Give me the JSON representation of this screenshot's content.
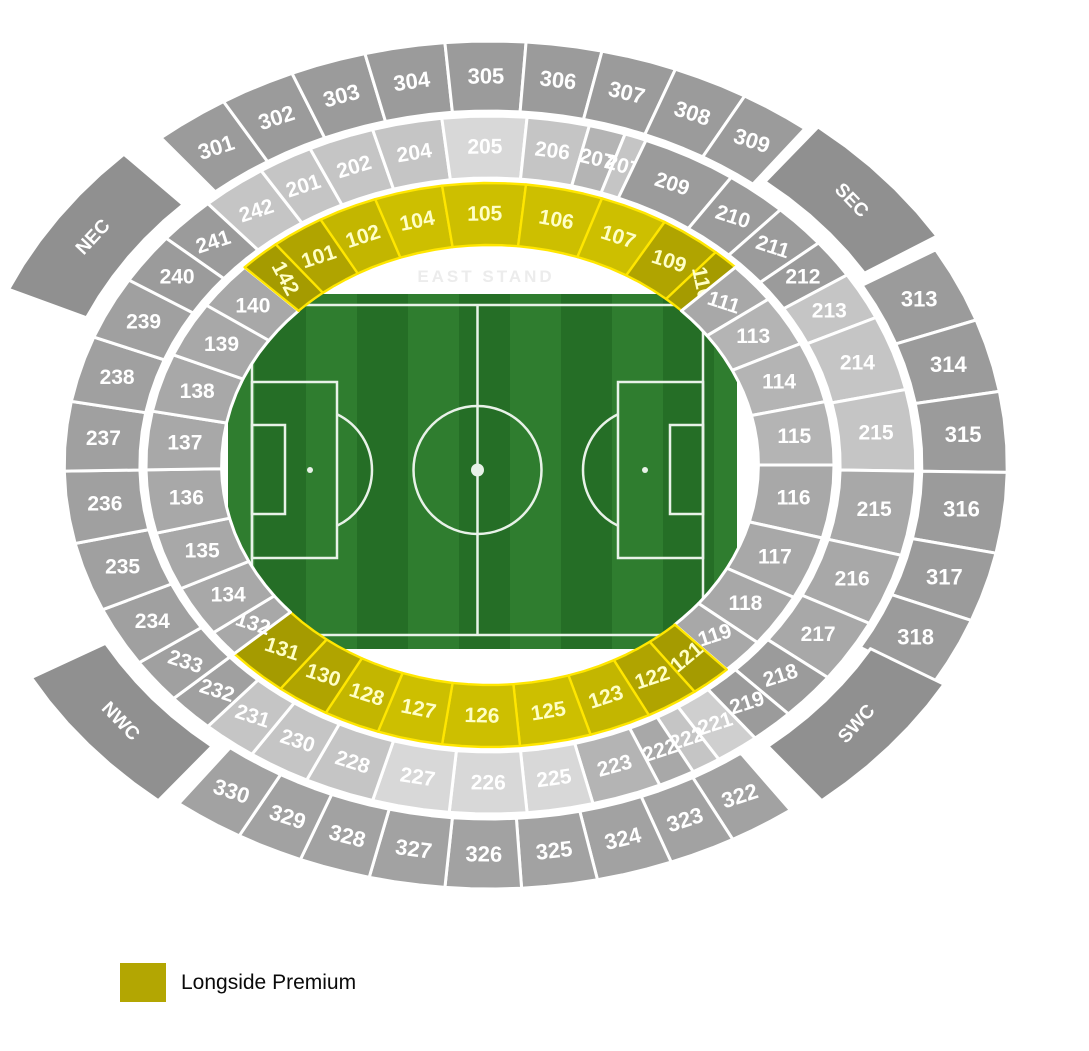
{
  "legend": {
    "label": "Longside Premium",
    "color": "#b3a602"
  },
  "stand_label": "EAST STAND",
  "palette": {
    "YB": "#cdbf00",
    "YB2": "#c3b600",
    "YM": "#b0a400",
    "YD": "#a59b00",
    "G1": "#9b9b9b",
    "G1b": "#a0a0a0",
    "G1c": "#a2a2a2",
    "G2": "#a8a8a8",
    "G3": "#b4b4b4",
    "G4": "#c5c5c5",
    "G5": "#d8d8d8",
    "G6": "#cfcfcf",
    "B": "#909090",
    "yellow_text": "#ffffc6",
    "white_text": "#ffffff",
    "stroke_yellow": "#ffe600",
    "stroke_white": "#ffffff"
  },
  "stadium": {
    "cx": 490,
    "cy": 465,
    "kx": 1.22,
    "ky": 1.0,
    "rings": {
      "r1": [
        220,
        282
      ],
      "r2": [
        287,
        349
      ],
      "r3": [
        354,
        424
      ],
      "b": [
        362,
        432
      ]
    },
    "font_by_ring": {
      "r1": 21,
      "r2": 21,
      "r3": 22,
      "b": 19
    },
    "sections": [
      [
        "140",
        "r1",
        135.5,
        146,
        "G2",
        null
      ],
      [
        "142",
        "r1",
        128.5,
        135.5,
        "YD",
        62
      ],
      [
        "101",
        "r1",
        119.5,
        128.5,
        "YM",
        null
      ],
      [
        "102",
        "r1",
        109.5,
        119.5,
        "YB2",
        null
      ],
      [
        "104",
        "r1",
        98,
        109.5,
        "YB",
        null
      ],
      [
        "105",
        "r1",
        84,
        98,
        "YB",
        null
      ],
      [
        "106",
        "r1",
        71,
        84,
        "YB",
        null
      ],
      [
        "107",
        "r1",
        59.5,
        71,
        "YB",
        null
      ],
      [
        "109",
        "r1",
        49,
        59.5,
        "YM",
        null
      ],
      [
        "110",
        "r1",
        43.5,
        49,
        "YD",
        78
      ],
      [
        "111",
        "r1",
        36,
        44.5,
        "G2",
        null
      ],
      [
        "113",
        "r1",
        25.5,
        36,
        "G3",
        null
      ],
      [
        "114",
        "r1",
        13,
        25.5,
        "G3",
        null
      ],
      [
        "115",
        "r1",
        0,
        13,
        "G3",
        null
      ],
      [
        "116",
        "r1",
        345,
        360,
        "G2",
        null
      ],
      [
        "117",
        "r1",
        332,
        345,
        "G2",
        null
      ],
      [
        "118",
        "r1",
        321,
        332,
        "G2",
        null
      ],
      [
        "119",
        "r1",
        313.5,
        321,
        "G2",
        null
      ],
      [
        "121",
        "r1",
        306.5,
        313.5,
        "YD",
        -40
      ],
      [
        "122",
        "r1",
        297.5,
        306.5,
        "YM",
        null
      ],
      [
        "123",
        "r1",
        287,
        297.5,
        "YB2",
        null
      ],
      [
        "125",
        "r1",
        275,
        287,
        "YB",
        null
      ],
      [
        "126",
        "r1",
        262,
        275,
        "YB",
        null
      ],
      [
        "127",
        "r1",
        251,
        262,
        "YB",
        null
      ],
      [
        "128",
        "r1",
        241.5,
        251,
        "YB2",
        null
      ],
      [
        "130",
        "r1",
        232.5,
        241.5,
        "YM",
        null
      ],
      [
        "131",
        "r1",
        222,
        232.5,
        "YD",
        null
      ],
      [
        "132",
        "r1",
        216.5,
        222,
        "G2",
        null
      ],
      [
        "134",
        "r1",
        206,
        216.5,
        "G2",
        null
      ],
      [
        "135",
        "r1",
        194,
        206,
        "G2",
        null
      ],
      [
        "136",
        "r1",
        181,
        194,
        "G2",
        null
      ],
      [
        "137",
        "r1",
        169,
        181,
        "G2",
        null
      ],
      [
        "138",
        "r1",
        157,
        169,
        "G2",
        null
      ],
      [
        "139",
        "r1",
        145.5,
        157,
        "G2",
        null
      ],
      [
        "241",
        "r2",
        131.5,
        139.5,
        "G1",
        null
      ],
      [
        "242",
        "r2",
        122.5,
        131.5,
        "G4",
        null
      ],
      [
        "201",
        "r2",
        115,
        122.5,
        "G4",
        null
      ],
      [
        "202",
        "r2",
        106,
        115,
        "G4",
        null
      ],
      [
        "204",
        "r2",
        96.5,
        106,
        "G4",
        null
      ],
      [
        "205",
        "r2",
        85,
        96.5,
        "G5",
        null
      ],
      [
        "206",
        "r2",
        76.5,
        85,
        "G4",
        null
      ],
      [
        "207",
        "r2",
        71.5,
        76.5,
        "G3",
        null
      ],
      [
        "207",
        "r2",
        68.5,
        71.5,
        "G4",
        null
      ],
      [
        "209",
        "r2",
        55.5,
        68.5,
        "G1",
        null
      ],
      [
        "210",
        "r2",
        47,
        55.5,
        "G1",
        null
      ],
      [
        "211",
        "r2",
        39.5,
        47,
        "G1",
        null
      ],
      [
        "212",
        "r2",
        33,
        39.5,
        "G1",
        null
      ],
      [
        "213",
        "r2",
        25,
        33,
        "G4",
        null
      ],
      [
        "214",
        "r2",
        12.5,
        25,
        "G4",
        null
      ],
      [
        "215",
        "r2",
        -1,
        12.5,
        "G4",
        null
      ],
      [
        "215",
        "r2",
        345,
        359,
        "G2",
        null
      ],
      [
        "216",
        "r2",
        333,
        345,
        "G2",
        null
      ],
      [
        "217",
        "r2",
        322.5,
        333,
        "G2",
        null
      ],
      [
        "218",
        "r2",
        314.5,
        322.5,
        "G1",
        null
      ],
      [
        "219",
        "r2",
        308.5,
        314.5,
        "G1",
        null
      ],
      [
        "221",
        "r2",
        302.5,
        308.5,
        "G6",
        null
      ],
      [
        "222",
        "r2",
        298.5,
        302.5,
        "G4",
        null
      ],
      [
        "222",
        "r2",
        293.5,
        298.5,
        "G2",
        null
      ],
      [
        "223",
        "r2",
        284,
        293.5,
        "G3",
        null
      ],
      [
        "225",
        "r2",
        275,
        284,
        "G5",
        null
      ],
      [
        "226",
        "r2",
        264.5,
        275,
        "G5",
        null
      ],
      [
        "227",
        "r2",
        254,
        264.5,
        "G5",
        null
      ],
      [
        "228",
        "r2",
        244.5,
        254,
        "G4",
        null
      ],
      [
        "230",
        "r2",
        236,
        244.5,
        "G4",
        null
      ],
      [
        "231",
        "r2",
        228.5,
        236,
        "G4",
        null
      ],
      [
        "232",
        "r2",
        222,
        228.5,
        "G1b",
        null
      ],
      [
        "233",
        "r2",
        214.5,
        222,
        "G1b",
        null
      ],
      [
        "234",
        "r2",
        204.5,
        214.5,
        "G1b",
        null
      ],
      [
        "235",
        "r2",
        193,
        204.5,
        "G1b",
        null
      ],
      [
        "236",
        "r2",
        181,
        193,
        "G1b",
        null
      ],
      [
        "237",
        "r2",
        169.5,
        181,
        "G1b",
        null
      ],
      [
        "238",
        "r2",
        158.5,
        169.5,
        "G1b",
        null
      ],
      [
        "239",
        "r2",
        148,
        158.5,
        "G1b",
        null
      ],
      [
        "240",
        "r2",
        139.5,
        148,
        "G1",
        null
      ],
      [
        "301",
        "r3",
        121,
        129.5,
        "G1",
        null
      ],
      [
        "302",
        "r3",
        112.5,
        121,
        "G1",
        null
      ],
      [
        "303",
        "r3",
        104,
        112.5,
        "G1",
        null
      ],
      [
        "304",
        "r3",
        95,
        104,
        "G1",
        null
      ],
      [
        "305",
        "r3",
        86,
        95,
        "G1",
        null
      ],
      [
        "306",
        "r3",
        77.5,
        86,
        "G1",
        null
      ],
      [
        "307",
        "r3",
        69,
        77.5,
        "G1",
        null
      ],
      [
        "308",
        "r3",
        60.5,
        69,
        "G1",
        null
      ],
      [
        "309",
        "r3",
        52.5,
        60.5,
        "G1",
        null
      ],
      [
        "313",
        "r3",
        20,
        30.5,
        "G1",
        null
      ],
      [
        "314",
        "r3",
        10,
        20,
        "G1",
        null
      ],
      [
        "315",
        "r3",
        -1,
        10,
        "G1",
        null
      ],
      [
        "316",
        "r3",
        348,
        359,
        "G1",
        null
      ],
      [
        "317",
        "r3",
        338.5,
        348,
        "G1",
        null
      ],
      [
        "318",
        "r3",
        329,
        338.5,
        "G1",
        null
      ],
      [
        "322",
        "r3",
        298,
        305.5,
        "G1c",
        null
      ],
      [
        "323",
        "r3",
        290.5,
        298,
        "G1c",
        null
      ],
      [
        "324",
        "r3",
        282,
        290.5,
        "G1c",
        null
      ],
      [
        "325",
        "r3",
        273.5,
        282,
        "G1c",
        null
      ],
      [
        "326",
        "r3",
        265,
        273.5,
        "G1c",
        null
      ],
      [
        "327",
        "r3",
        256.5,
        265,
        "G1c",
        null
      ],
      [
        "328",
        "r3",
        248.5,
        256.5,
        "G1c",
        null
      ],
      [
        "329",
        "r3",
        241,
        248.5,
        "G1c",
        null
      ],
      [
        "330",
        "r3",
        233,
        241,
        "G1c",
        null
      ],
      [
        "NEC",
        "b",
        134,
        156,
        "B",
        -47
      ],
      [
        "SEC",
        "b",
        32,
        51.5,
        "B",
        46
      ],
      [
        "NWC",
        "b",
        209.5,
        231,
        "B",
        46
      ],
      [
        "SWC",
        "b",
        309,
        329.5,
        "B",
        -48
      ]
    ]
  },
  "pitch": {
    "x": 228,
    "y": 294,
    "w": 509,
    "h": 355,
    "stripe_w": 51,
    "grass_light": "#2f7d2f",
    "grass_dark": "#256e26",
    "line": "#e8f2e8",
    "bx1": 252,
    "by1": 305,
    "bx2": 703,
    "by2": 635,
    "box_depth": 85,
    "box_top": 382,
    "box_bot": 558,
    "goal_depth": 33,
    "goal_top": 425,
    "goal_bot": 514,
    "spot_dx": 58,
    "arc_r": 62,
    "circle_r": 64,
    "corner_r": 11,
    "center_dot_r": 6.5,
    "spot_r": 3
  }
}
